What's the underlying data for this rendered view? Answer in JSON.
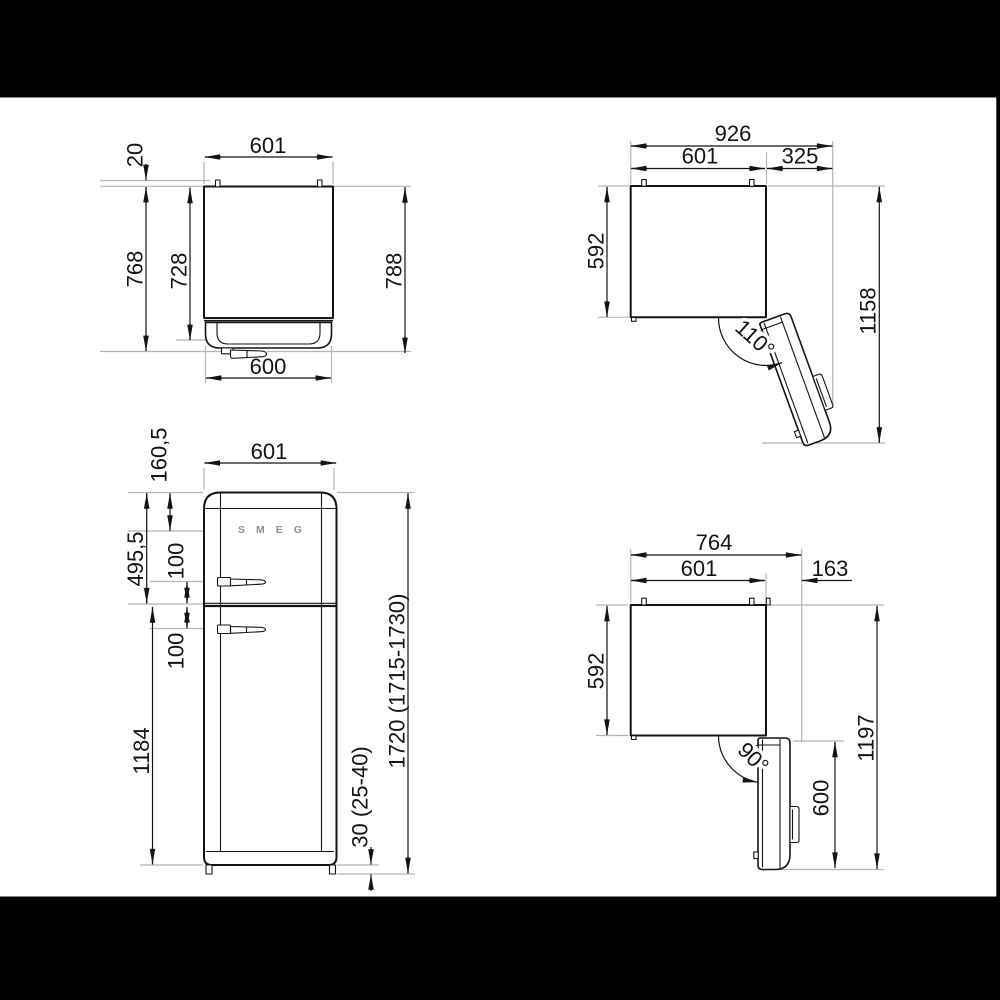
{
  "colors": {
    "background": "#ffffff",
    "letterbox": "#000000",
    "line": "#141414",
    "extension": "#b5b5b5",
    "logo_gray": "#8f8f8f"
  },
  "views": {
    "top_closed": {
      "dims": {
        "width": "601",
        "rear_clearance": "20",
        "depth_outer": "768",
        "depth_inner": "728",
        "depth_total": "788",
        "door_width": "600"
      }
    },
    "top_open_110": {
      "dims": {
        "total_width": "926",
        "body_width": "601",
        "door_projection": "325",
        "body_depth": "592",
        "total_depth": "1158",
        "door_angle": "110°"
      }
    },
    "front": {
      "logo": "SMEG",
      "dims": {
        "width": "601",
        "logo_offset": "160,5",
        "fridge_section": "495,5",
        "upper_handle": "100",
        "lower_handle": "100",
        "lower_door": "1184",
        "total_height": "1720 (1715-1730)",
        "feet_height": "30 (25-40)"
      }
    },
    "top_open_90": {
      "dims": {
        "total_width": "764",
        "body_width": "601",
        "door_projection": "163",
        "body_depth": "592",
        "total_depth": "1197",
        "door_depth": "600",
        "door_angle": "90°"
      }
    }
  }
}
